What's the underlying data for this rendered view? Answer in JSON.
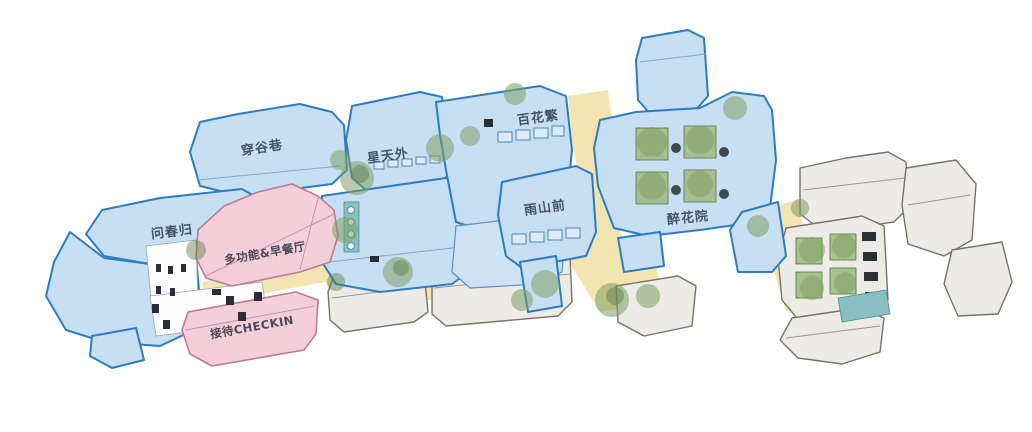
{
  "plan": {
    "type": "axonometric-site-plan",
    "labels": {
      "chuanguxiang": "穿谷巷",
      "wenchungui": "问春归",
      "xingtianwai": "星天外",
      "baihuafan": "百花繁",
      "yushanqian": "雨山前",
      "zuihuayuan": "醉花院",
      "duogongneng": "多功能&早餐厅",
      "jiedai": "接待CHECKIN"
    },
    "palette": {
      "background": "#ffffff",
      "guesthouse_blue_fill": "#c7dff3",
      "guesthouse_blue_line": "#2e7cbe",
      "service_pink_fill": "#f4cfd9",
      "service_pink_line": "#bb7b95",
      "context_gray_fill": "#ecebe6",
      "context_gray_line": "#76746c",
      "path_yellow": "#f3e5b2",
      "tree_green": "#7d9e62",
      "pool_teal": "#8abfc2",
      "label_color": "#44546a"
    }
  }
}
